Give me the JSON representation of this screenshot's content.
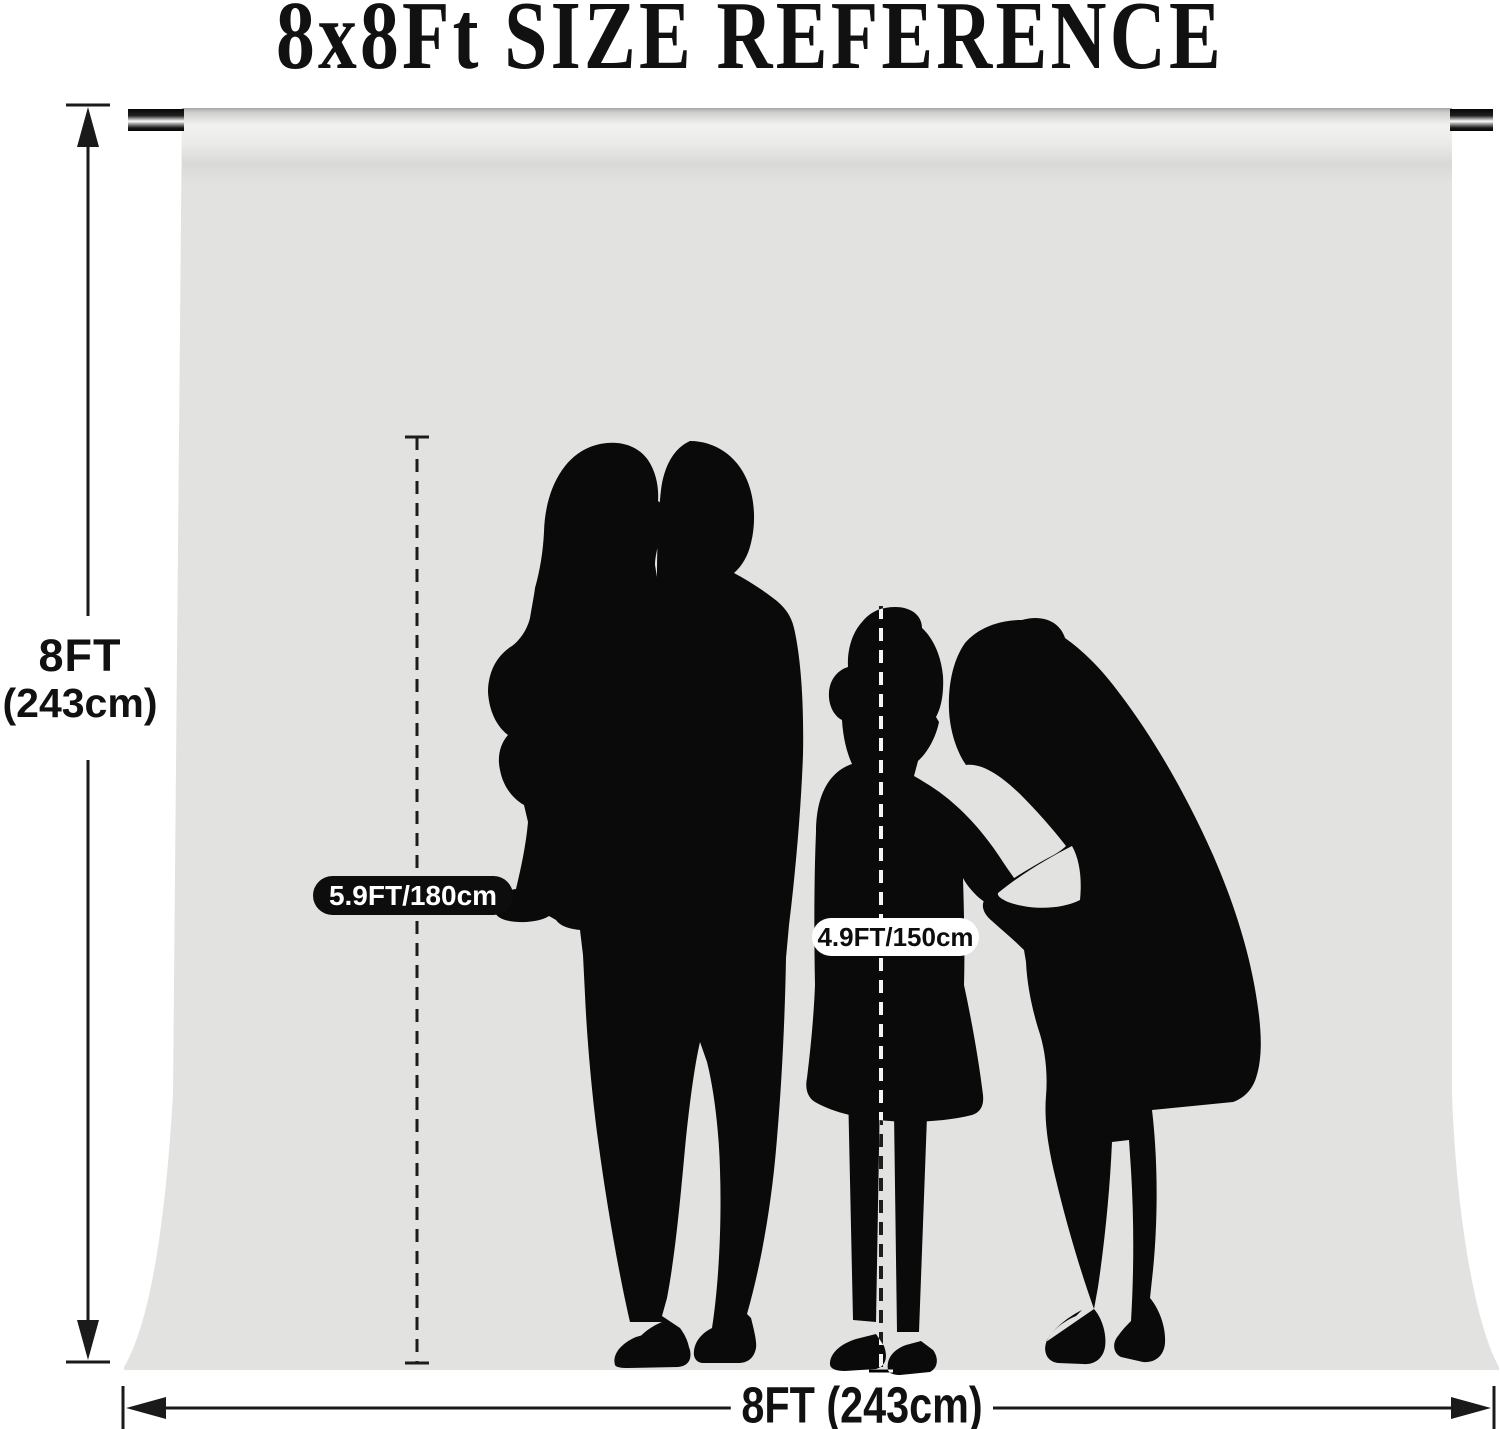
{
  "title": "8x8Ft SIZE REFERENCE",
  "dimensions": {
    "height_label_line1": "8FT",
    "height_label_line2": "(243cm)",
    "width_label": "8FT (243cm)"
  },
  "annotations": {
    "adult_height_label": "5.9FT/180cm",
    "child_height_label": "4.9FT/150cm"
  },
  "figures": [
    "man-holding-toddler-silhouette",
    "girl-silhouette",
    "woman-leaning-silhouette"
  ],
  "colors": {
    "page_background": "#ffffff",
    "backdrop_gray": "#e2e2e0",
    "silhouette_black": "#0a0a0a",
    "dimension_line": "#1a1a1a",
    "adult_pill_background": "#0d0d0d",
    "adult_pill_text": "#ffffff",
    "child_pill_background": "#ffffff",
    "child_pill_text": "#0d0d0d"
  }
}
